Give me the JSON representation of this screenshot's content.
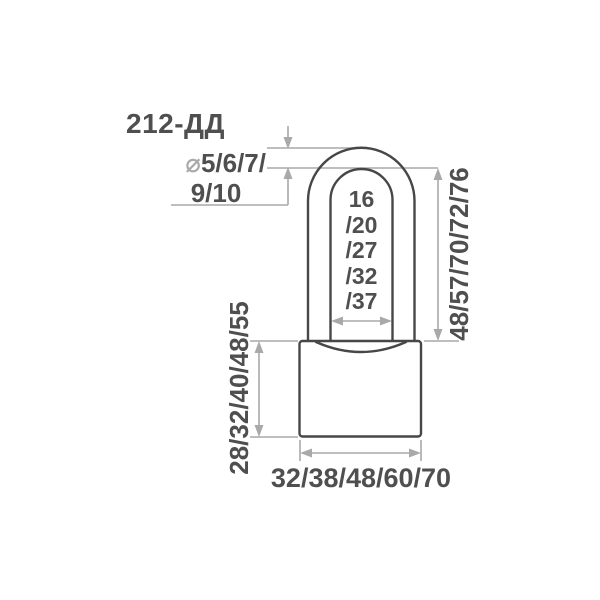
{
  "diagram": {
    "kind": "padlock-technical-drawing",
    "colors": {
      "background": "#ffffff",
      "outline": "#474747",
      "dimension": "#a9a9a9",
      "text": "#4f4f4f"
    }
  },
  "labels": {
    "model": "212-ДД",
    "shackle_diameter": {
      "symbol": "⌀",
      "line1": "5/6/7/",
      "line2": "9/10"
    },
    "shackle_inner_width": [
      "16",
      "/20",
      "/27",
      "/32",
      "/37"
    ],
    "shackle_height": "48/57/70/72/76",
    "body_height": "28/32/40/48/55",
    "body_width": "32/38/48/60/70"
  }
}
